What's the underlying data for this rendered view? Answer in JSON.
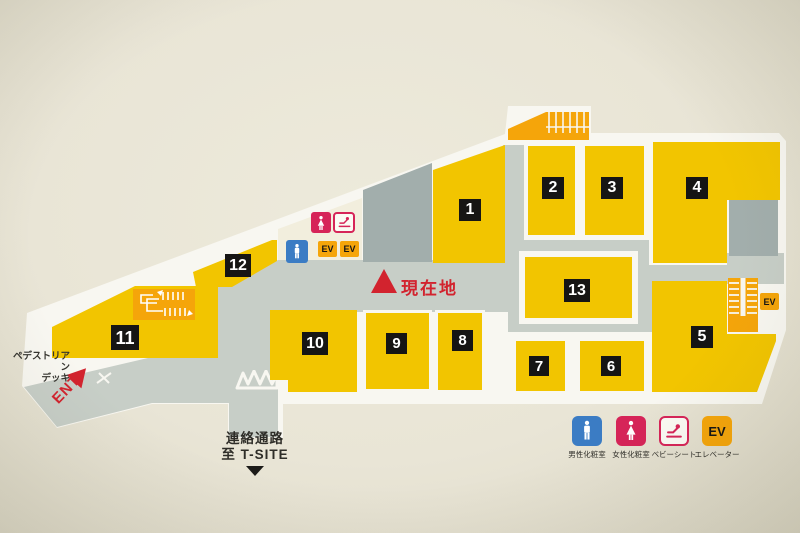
{
  "labels": {
    "current_location": "現在地",
    "ent": "ENT",
    "deck_line1": "ペデストリアン",
    "deck_line2": "デッキ",
    "passage_line1": "連絡通路",
    "passage_line2": "至 T-SITE",
    "ev": "EV"
  },
  "shops": [
    {
      "number": "1"
    },
    {
      "number": "2"
    },
    {
      "number": "3"
    },
    {
      "number": "4"
    },
    {
      "number": "5"
    },
    {
      "number": "6"
    },
    {
      "number": "7"
    },
    {
      "number": "8"
    },
    {
      "number": "9"
    },
    {
      "number": "10"
    },
    {
      "number": "11"
    },
    {
      "number": "12"
    },
    {
      "number": "13"
    }
  ],
  "legend": [
    {
      "icon": "male-restroom-icon",
      "label": "男性化粧室"
    },
    {
      "icon": "female-restroom-icon",
      "label": "女性化粧室"
    },
    {
      "icon": "baby-seat-icon",
      "label": "ベビーシート"
    },
    {
      "icon": "elevator-icon",
      "label": "エレベーター"
    }
  ],
  "colors": {
    "shop-yellow": "#f2c500",
    "facility-orange": "#f5a50a",
    "corridor-gray": "#c7cec7",
    "backroom-gray": "#a2aeac",
    "map-white": "#f8f7f1",
    "bg-cream": "#e9e5d6",
    "interior-cream": "#f2eedd",
    "badge-black": "#161514",
    "accent-red": "#d2232e",
    "male-blue": "#3b7cc4",
    "female-pink": "#d62458",
    "text-dark": "#35342f"
  }
}
